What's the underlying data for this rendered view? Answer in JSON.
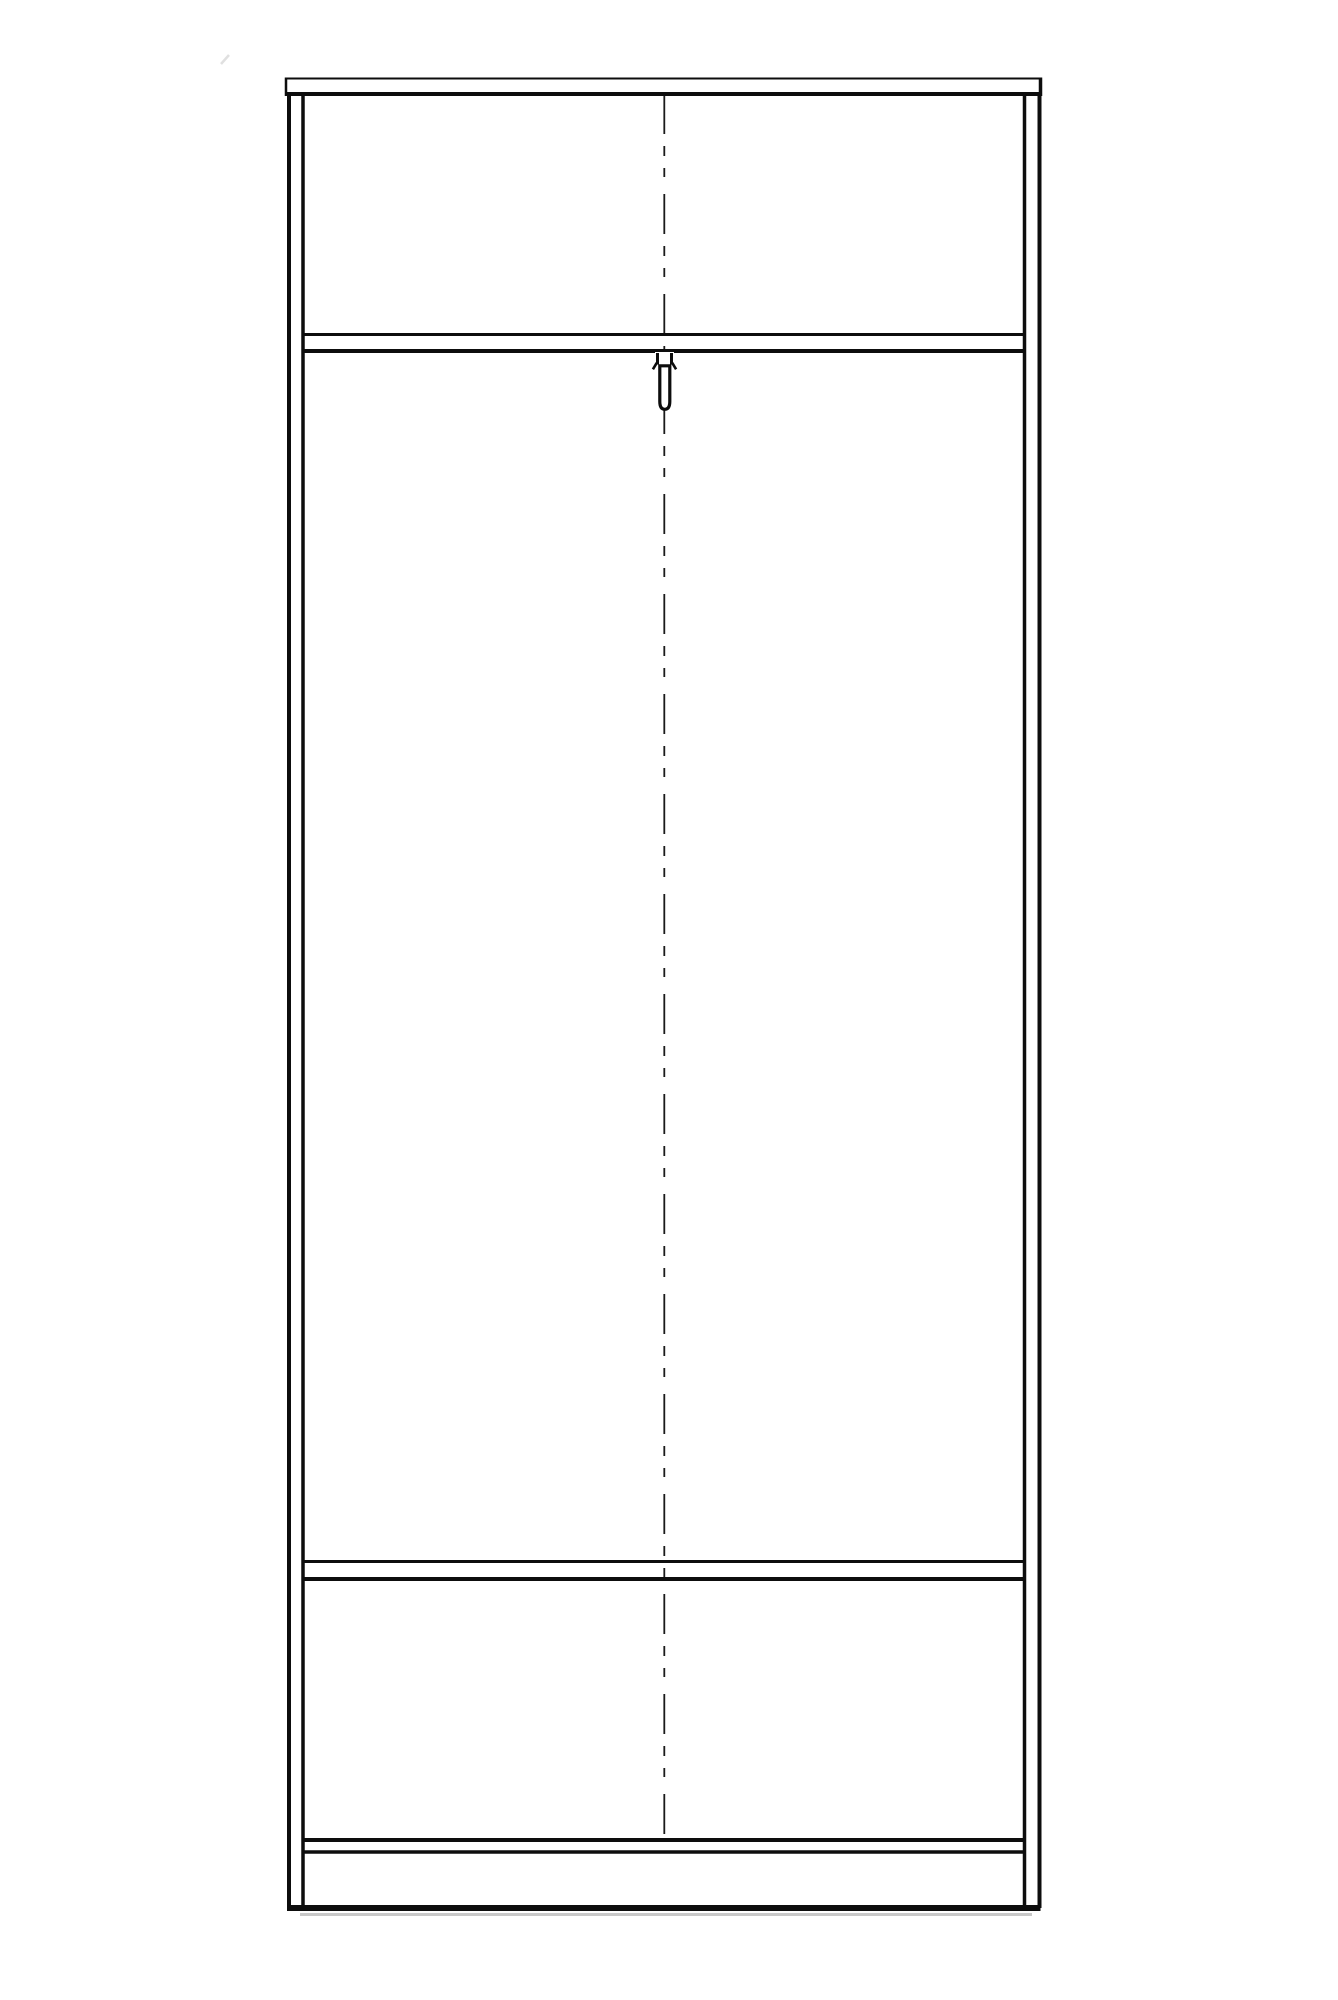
{
  "page": {
    "background": "#ffffff"
  },
  "colors": {
    "line": "#0d0d0d",
    "centerline": "#1a1a1a",
    "shadow": "#c8c8c8",
    "artifact": "#e0e0e0",
    "panel_fill": "#ffffff"
  },
  "drawing": {
    "kind": "furniture-front-elevation-line-drawing",
    "components": {
      "top_panel": "top-panel",
      "left_side_panel": "left-side-panel",
      "right_side_panel": "right-side-panel",
      "upper_shelf": "upper-shelf",
      "hanger_hook": "hanger-hook",
      "lower_shelf": "lower-shelf",
      "bottom_panel": "bottom-panel",
      "base_bottom_edge": "base-bottom-edge",
      "centerline": "vertical-centerline"
    }
  }
}
